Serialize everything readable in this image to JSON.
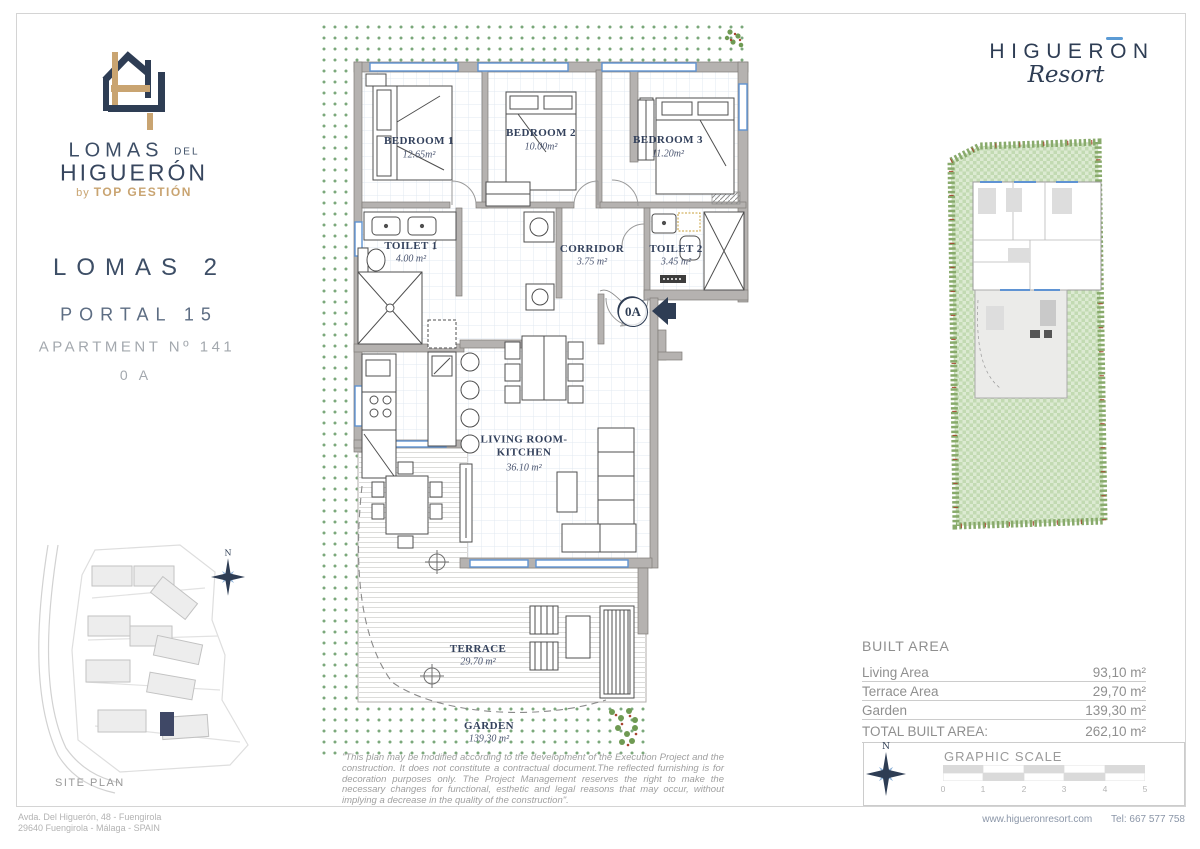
{
  "colors": {
    "navy": "#2e3d54",
    "tan": "#c9a471",
    "window_blue": "#5f93d3",
    "garden_green": "#4e8a4e",
    "wall_gray": "#b5b2b0",
    "highlight_unit": "#3f4866"
  },
  "brand": {
    "name_main": "LOMAS",
    "name_del": "DEL",
    "name_sub": "HIGUERÓN",
    "byline_by": "by",
    "byline_brand": "TOP GESTIÓN"
  },
  "resort": {
    "name": "HIGUERON",
    "script": "Resort"
  },
  "apartment_info": {
    "building": "LOMAS 2",
    "portal": "PORTAL 15",
    "apartment": "APARTMENT Nº 141",
    "unit": "0 A"
  },
  "site_plan": {
    "label": "SITE PLAN"
  },
  "north_label": "N",
  "floor_plan": {
    "entrance_label": "0A",
    "rooms": [
      {
        "name": "BEDROOM 1",
        "area": "12.65m²"
      },
      {
        "name": "BEDROOM 2",
        "area": "10.00m²"
      },
      {
        "name": "BEDROOM 3",
        "area": "11.20m²"
      },
      {
        "name": "TOILET 1",
        "area": "4.00 m²"
      },
      {
        "name": "CORRIDOR",
        "area": "3.75 m²"
      },
      {
        "name": "TOILET 2",
        "area": "3.45 m²"
      },
      {
        "name": "LIVING ROOM-KITCHEN",
        "area": "36.10 m²"
      },
      {
        "name": "TERRACE",
        "area": "29.70 m²"
      },
      {
        "name": "GARDEN",
        "area": "139,30 m²"
      }
    ]
  },
  "built_area": {
    "title": "BUILT AREA",
    "rows": [
      {
        "label": "Living Area",
        "value": "93,10 m²"
      },
      {
        "label": "Terrace Area",
        "value": "29,70 m²"
      },
      {
        "label": "Garden",
        "value": "139,30 m²"
      },
      {
        "label": "TOTAL BUILT AREA:",
        "value": "262,10 m²"
      }
    ]
  },
  "graphic_scale": {
    "title": "GRAPHIC SCALE",
    "ticks": [
      "0",
      "1",
      "2",
      "3",
      "4",
      "5"
    ]
  },
  "disclaimer": "\"This plan may be modified according to the development of the Execution Project and the construction. It does not constitute a contractual document.The reflected furnishing is for decoration purposes only. The Project Management reserves the right to make the necessary changes for functional, esthetic and legal reasons that may occur, without implying a decrease in the quality of the construction\".",
  "footer": {
    "address_line1": "Avda. Del Higuerón, 48 - Fuengirola",
    "address_line2": "29640 Fuengirola - Málaga - SPAIN",
    "website": "www.higueronresort.com",
    "phone": "Tel: 667 577 758"
  }
}
